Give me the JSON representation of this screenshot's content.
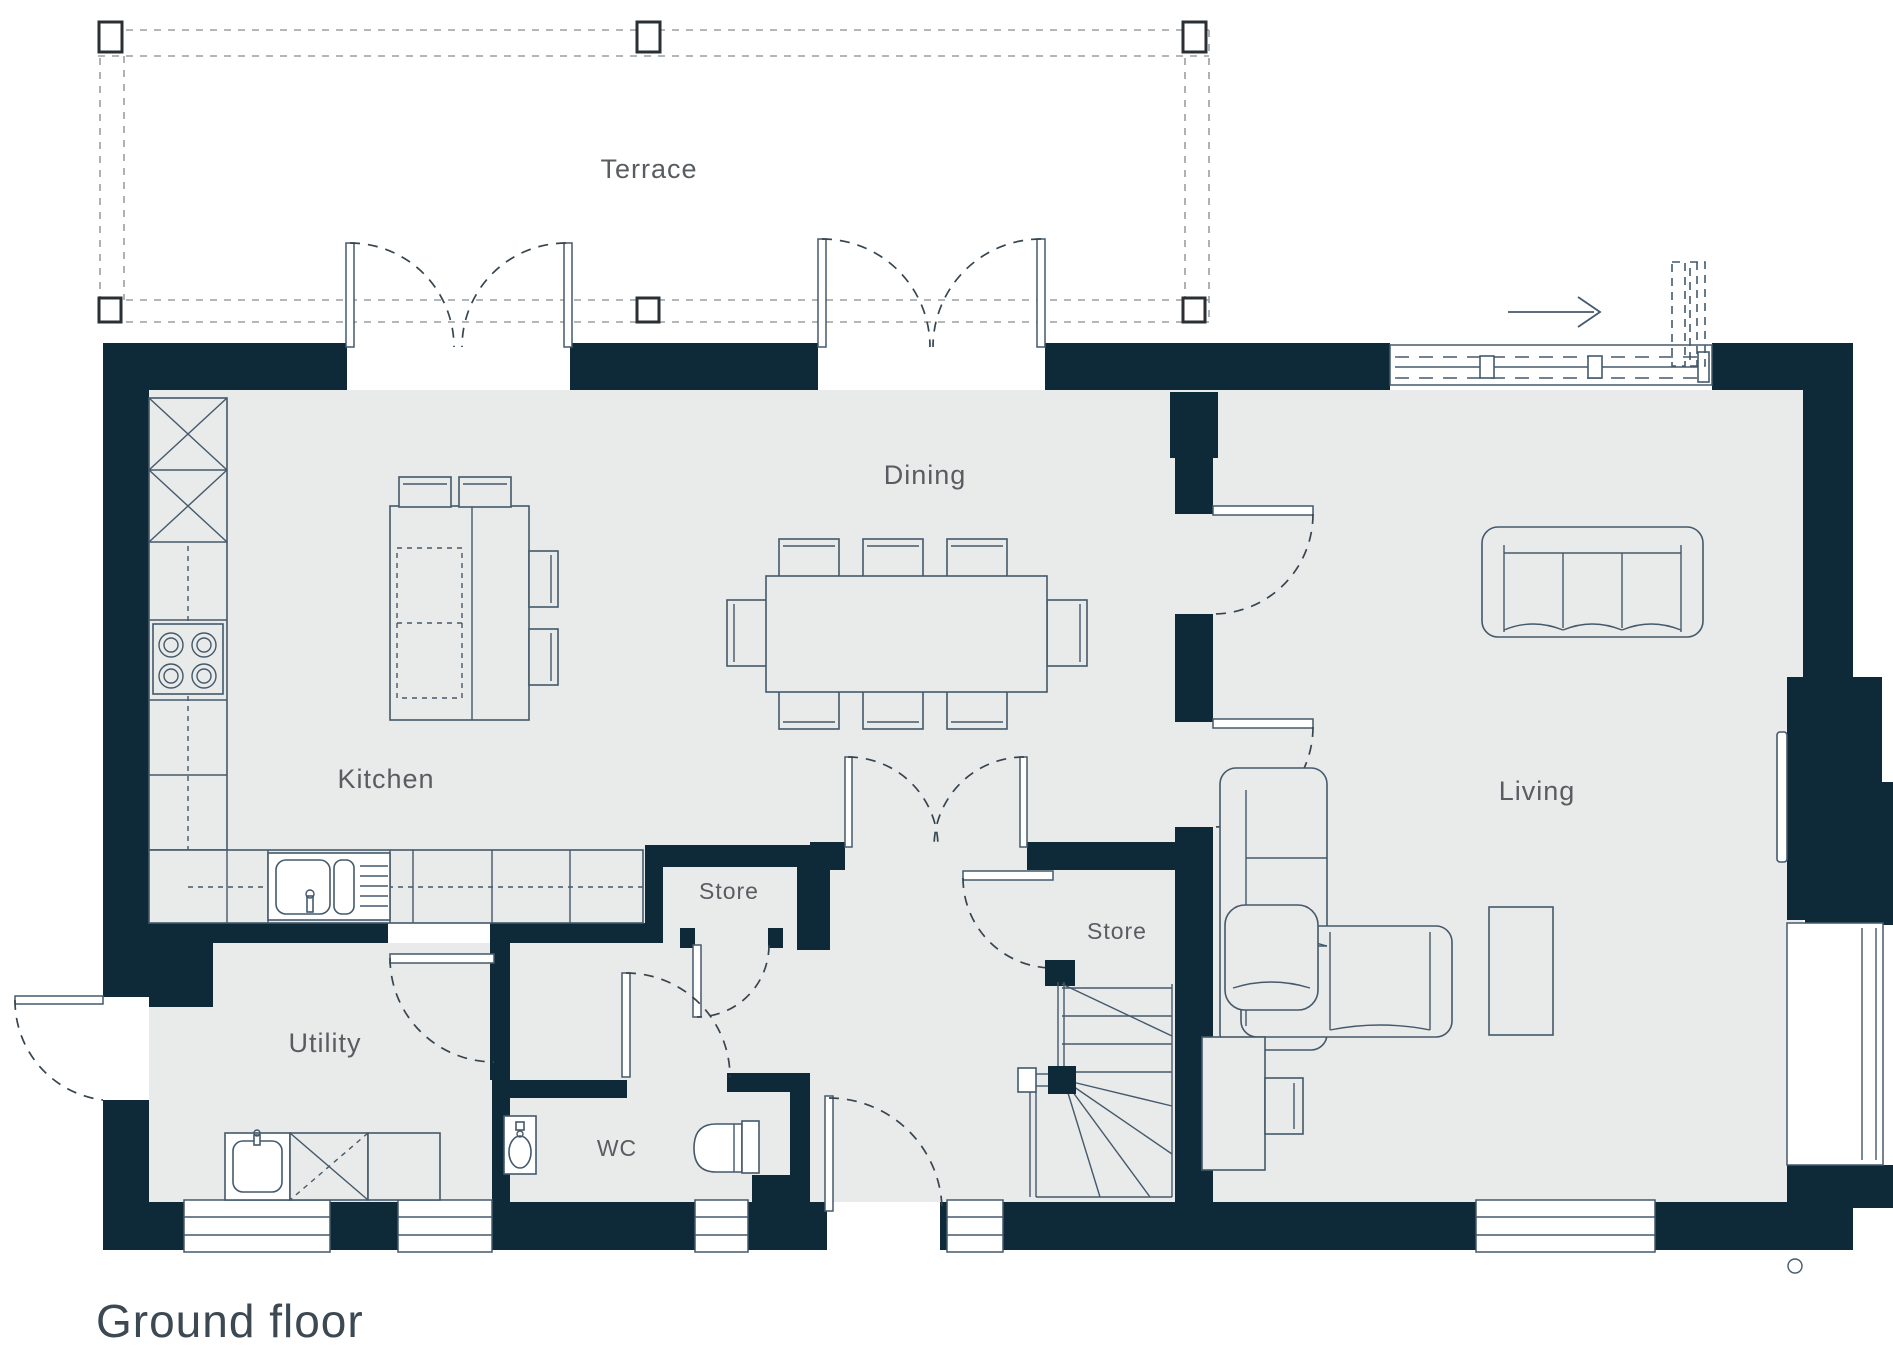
{
  "floor_title": "Ground floor",
  "rooms": {
    "terrace": "Terrace",
    "dining": "Dining",
    "kitchen": "Kitchen",
    "living": "Living",
    "store_hall": "Store",
    "store_stairs": "Store",
    "utility": "Utility",
    "wc": "WC"
  },
  "colors": {
    "wall": "#0e2a39",
    "floor": "#e9eaea",
    "fixture_line": "#44596b",
    "door_arc": "#37454f",
    "terrace_dash": "#9b9fa2",
    "label_text": "#585d61",
    "title_text": "#3c4852",
    "background": "#ffffff"
  }
}
